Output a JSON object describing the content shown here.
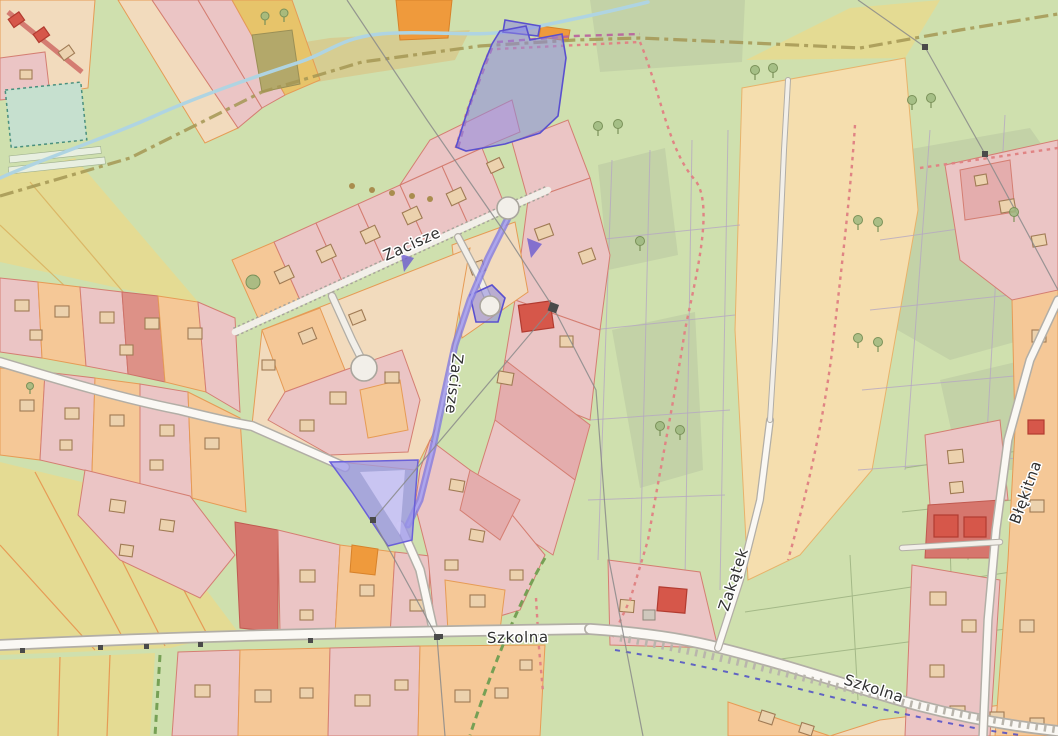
{
  "map": {
    "street_labels": {
      "zacisze_upper": "Zacisze",
      "zacisze_lower": "Zacisze",
      "szkolna_west": "Szkolna",
      "szkolna_east": "Szkolna",
      "zakatek": "Zakątek",
      "blekitna": "Błękitna"
    },
    "colors": {
      "highlight_purple": "#5a50cf",
      "highlight_fill": "#8c86e0",
      "road_fill": "#faf8f4",
      "road_casing": "#b2aea6",
      "meadow_green": "#cfe0ae",
      "woodland_green": "#c3d2a7",
      "field_yellow": "#e4db93",
      "field_orange": "#f5deae",
      "parcel_orange": "#f5c897",
      "parcel_pink": "#ebc5c5",
      "parcel_red": "#dd9187",
      "building_red": "#d6574a",
      "water_blue": "#afd4e2",
      "path_red": "#e08484",
      "boundary_olive": "#a59753",
      "cycleway_blue": "#4343c8",
      "label_color": "#2f2f2f"
    }
  }
}
